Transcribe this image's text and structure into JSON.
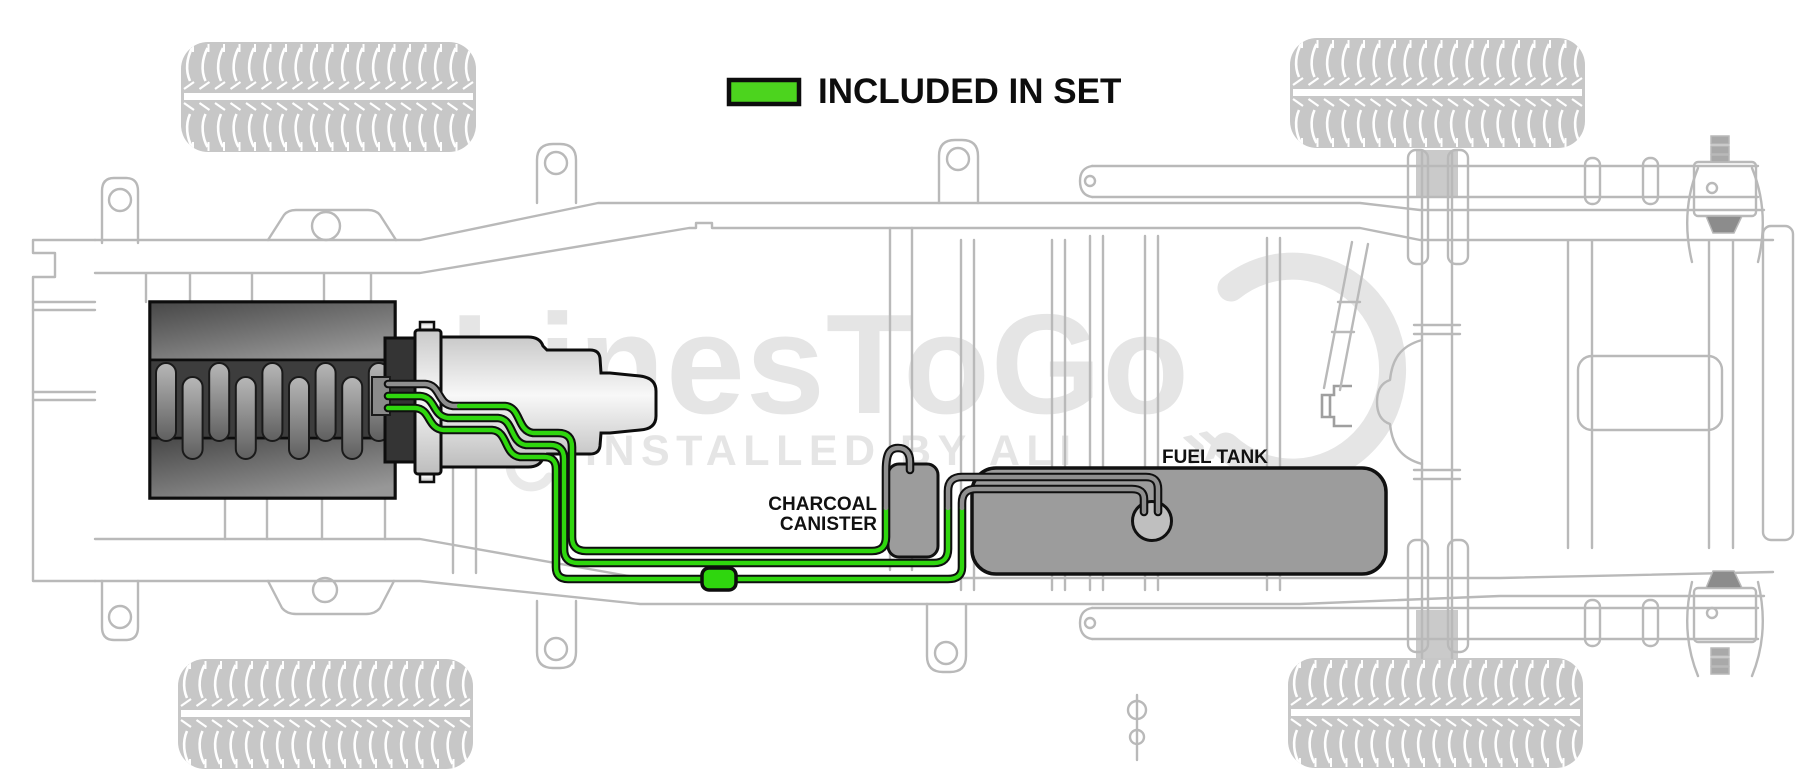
{
  "legend": {
    "label": "INCLUDED IN SET",
    "swatch_meaning": "green-highlighted fuel lines are included in set"
  },
  "labels": {
    "charcoal_canister": [
      "CHARCOAL",
      "CANISTER"
    ],
    "fuel_tank": "FUEL TANK"
  },
  "watermark": {
    "brand": "LinesToGo",
    "tagline": "INSTALLED BY ALI",
    "chevron": "»"
  },
  "colors": {
    "line_green": "#2fd60e",
    "swatch_green": "#4cd41e",
    "line_gray": "#8f8f8f",
    "chassis_gray": "#b9b9b9",
    "watermark_gray": "#e5e5e5",
    "tank_fill": "#9c9c9c",
    "label_ink": "#111111"
  }
}
